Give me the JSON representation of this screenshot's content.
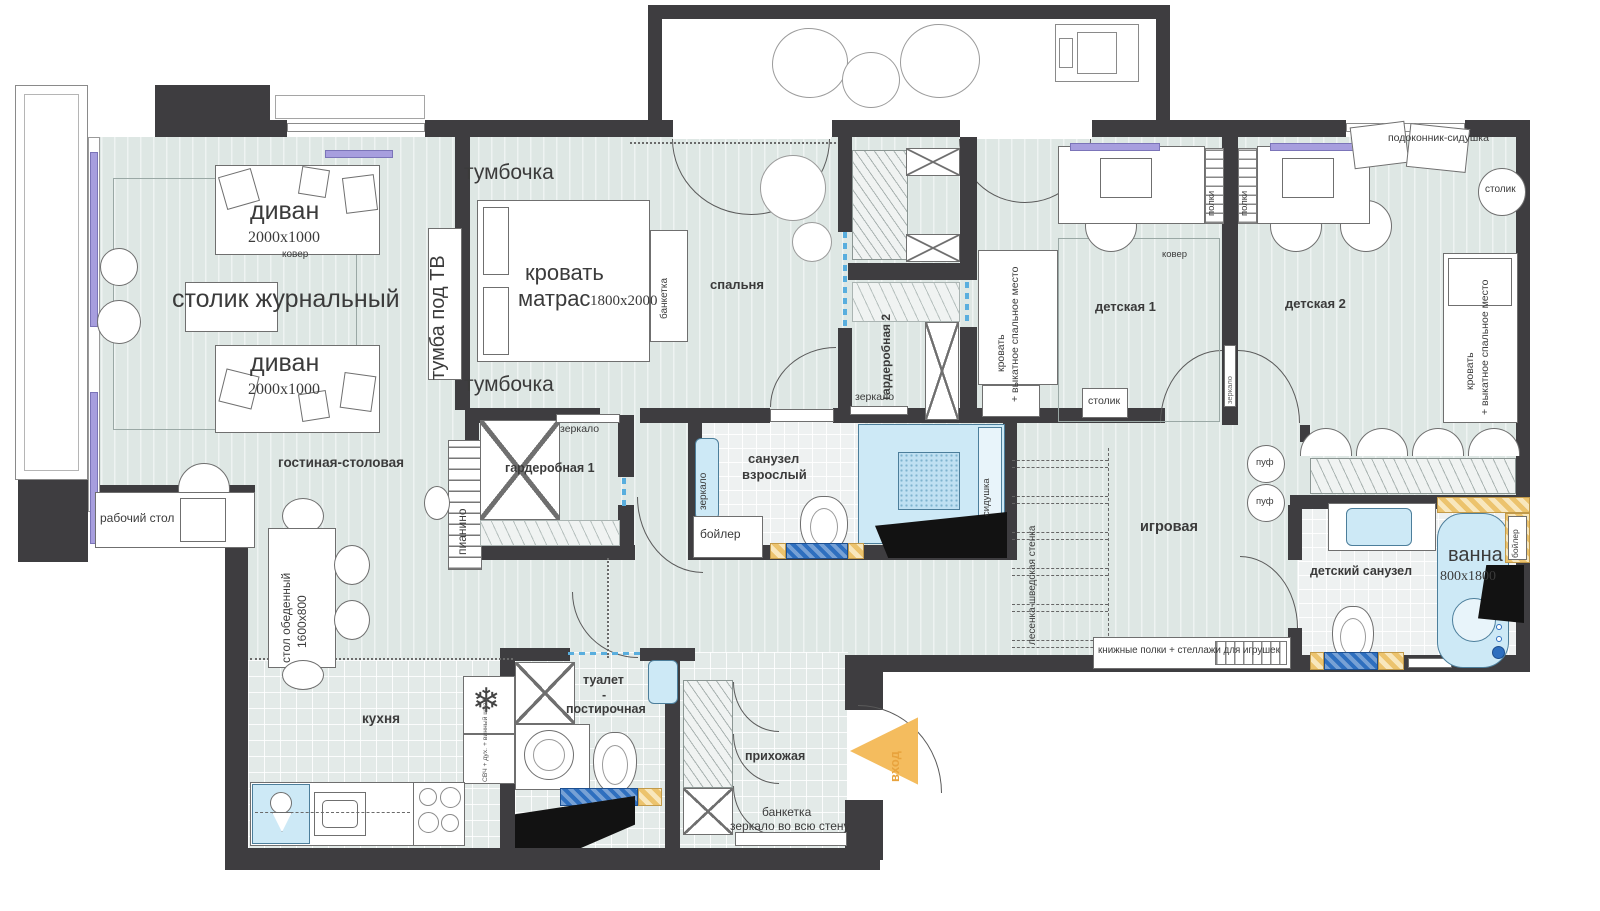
{
  "colors": {
    "wall": "#3e3d40",
    "floor": "#dee7e4",
    "tile_blue": "#2e6fbf",
    "fixture_blue": "#cde9f6",
    "accent_orange": "#f4bc5e",
    "hatch_orange": "#ecc36d",
    "radiator_purple": "#a79ede"
  },
  "rooms": {
    "living": "гостиная-столовая",
    "bedroom": "спальня",
    "kids1": "детская 1",
    "kids2": "детская 2",
    "wardrobe1": "гардеробная 1",
    "wardrobe2": "гардеробная 2",
    "bath_adult_line1": "санузел",
    "bath_adult_line2": "взрослый",
    "playroom": "игровая",
    "bath_kids": "детский санузел",
    "kitchen": "кухня",
    "laundry_line1": "туалет",
    "laundry_line2": "-",
    "laundry_line3": "постирочная",
    "hallway": "прихожая"
  },
  "furniture": {
    "sofa": "диван",
    "sofa_dim": "2000x1000",
    "rug": "ковер",
    "coffee_table": "столик журнальный",
    "tv_stand": "тумба под ТВ",
    "nightstand": "тумбочка",
    "bed_line1": "кровать",
    "bed_line2": "матрас",
    "bed_dim": "1800x2000",
    "bench": "банкетка",
    "mirror": "зеркало",
    "kid_bed_line1": "кровать",
    "kid_bed_line2": "+ выкатное спальное место",
    "kid_table": "столик",
    "shelves": "полки",
    "windowsill_seat": "подоконник-сидушка",
    "round_table": "столик",
    "work_desk": "рабочий стол",
    "dining_table": "стол обеденный",
    "dining_dim": "1600x800",
    "piano": "пианино",
    "boiler": "бойлер",
    "shower_seat": "сидушка",
    "ladder": "лесенка-шведская стенка",
    "pouf": "пуф",
    "book_shelves": "книжные полки + стеллажи для игрушек",
    "bath": "ванна",
    "bath_dim": "800x1800",
    "kitchen_appliances": "СВЧ + дух. + винный шкаф",
    "hall_bench": "банкетка",
    "hall_mirror": "зеркало во всю стену",
    "entrance": "вход"
  }
}
